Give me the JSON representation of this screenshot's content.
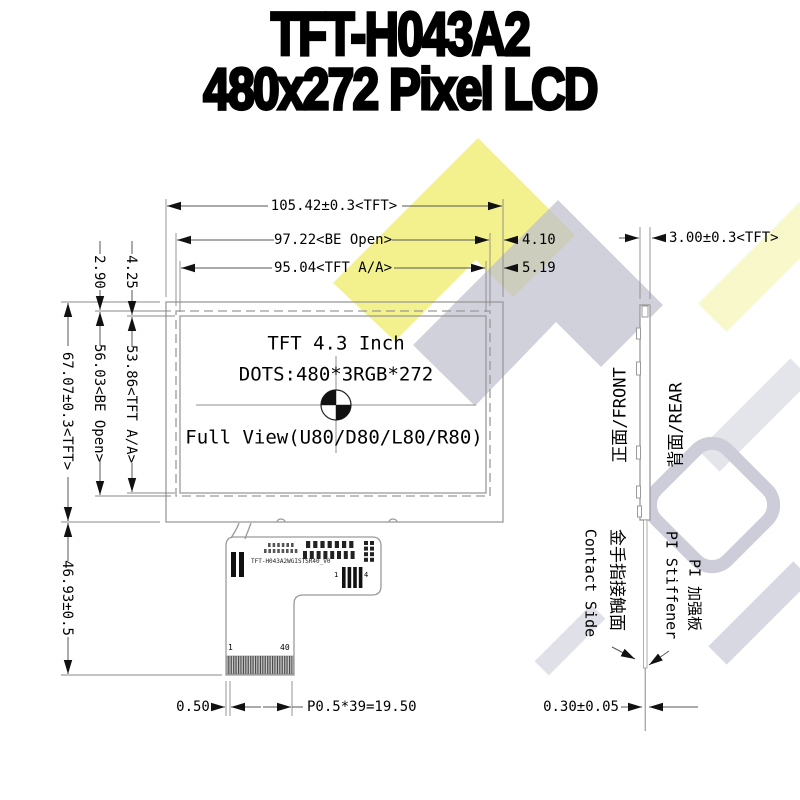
{
  "title": {
    "line1": "TFT-H043A2",
    "line2": "480x272 Pixel LCD"
  },
  "screen": {
    "line1": "TFT 4.3 Inch",
    "line2": "DOTS:480*3RGB*272",
    "line3": "Full View(U80/D80/L80/R80)"
  },
  "dims": {
    "width_tft": "105.42±0.3<TFT>",
    "width_be_open": "97.22<BE Open>",
    "offset_be_right": "4.10",
    "width_aa": "95.04<TFT A/A>",
    "offset_aa_right": "5.19",
    "thickness": "3.00±0.3<TFT>",
    "offset_aa_top": "4.25",
    "offset_be_top": "2.90",
    "height_tft": "67.07±0.3<TFT>",
    "height_be_open": "56.03<BE Open>",
    "height_aa": "53.86<TFT A/A>",
    "fpc_length": "46.93±0.5",
    "pin_margin": "0.50",
    "pin_pitch": "P0.5*39=19.50",
    "fpc_thickness": "0.30±0.05"
  },
  "fpc": {
    "part_number": "TFT-H043A2WGISTSR40_V0",
    "pin_first": "1",
    "pin_last": "40",
    "bar_first": "1",
    "bar_last": "4"
  },
  "side_view": {
    "front_label": "正面/FRONT",
    "rear_label": "背面/REAR",
    "contact_side_en": "Contact Side",
    "contact_side_cn": "金手指接触面",
    "stiffener_en": "PI Stiffener",
    "stiffener_cn": "PI 加强板"
  },
  "colors": {
    "watermark_yellow": "#ecea58",
    "watermark_gray": "#b5b5c7",
    "outline_gray": "#9a9a9a",
    "dim_line": "#555555",
    "text": "#000000"
  }
}
